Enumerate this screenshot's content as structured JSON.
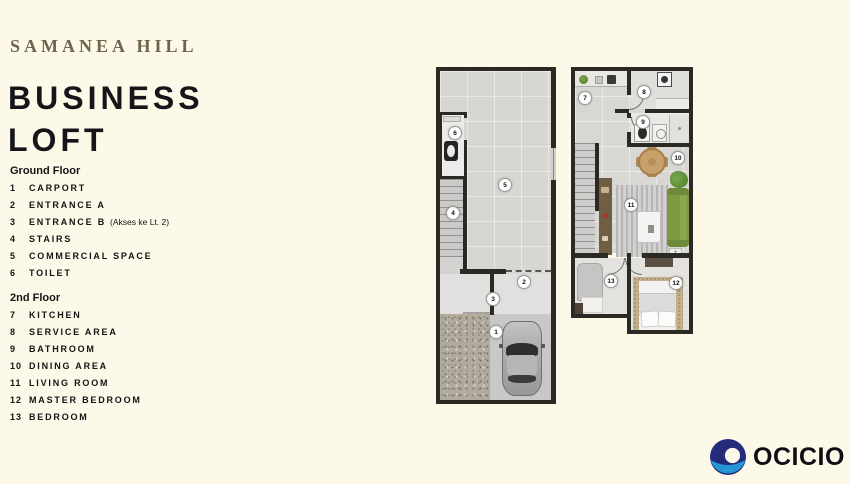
{
  "header": {
    "brand": "SAMANEA HILL",
    "title_line1": "BUSINESS",
    "title_line2": "LOFT"
  },
  "legend": {
    "ground": {
      "heading": "Ground Floor",
      "items": [
        {
          "num": "1",
          "label": "CARPORT"
        },
        {
          "num": "2",
          "label": "ENTRANCE A"
        },
        {
          "num": "3",
          "label": "ENTRANCE B",
          "note": "(Akses ke Lt. 2)"
        },
        {
          "num": "4",
          "label": "STAIRS"
        },
        {
          "num": "5",
          "label": "COMMERCIAL SPACE"
        },
        {
          "num": "6",
          "label": "TOILET"
        }
      ]
    },
    "second": {
      "heading": "2nd Floor",
      "items": [
        {
          "num": "7",
          "label": "KITCHEN"
        },
        {
          "num": "8",
          "label": "SERVICE AREA"
        },
        {
          "num": "9",
          "label": "BATHROOM"
        },
        {
          "num": "10",
          "label": "DINING AREA"
        },
        {
          "num": "11",
          "label": "LIVING ROOM"
        },
        {
          "num": "12",
          "label": "MASTER BEDROOM"
        },
        {
          "num": "13",
          "label": "BEDROOM"
        }
      ]
    }
  },
  "plans": {
    "ground": {
      "markers": {
        "m1": "1",
        "m2": "2",
        "m3": "3",
        "m4": "4",
        "m5": "5",
        "m6": "6"
      }
    },
    "second": {
      "markers": {
        "m7": "7",
        "m8": "8",
        "m9": "9",
        "m10": "10",
        "m11": "11",
        "m12": "12",
        "m13": "13"
      }
    }
  },
  "footer": {
    "logo_text": "OCICIO",
    "logo_icon": "ocicio-ring-icon",
    "colors": {
      "navy": "#232b7a",
      "blue": "#2595d6",
      "brand_olive": "#6e6449"
    }
  }
}
